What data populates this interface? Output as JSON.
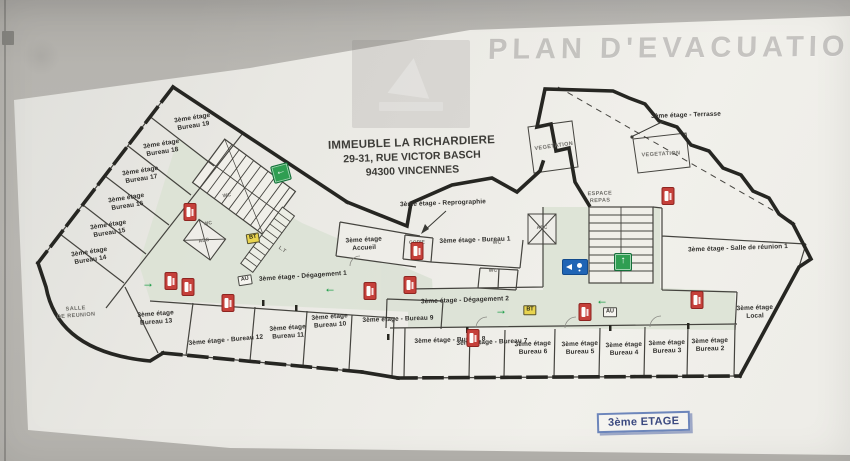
{
  "watermark": {
    "text": "PLAN D'EVACUATION"
  },
  "title": {
    "line1": "IMMEUBLE LA RICHARDIERE",
    "line2": "29-31, RUE VICTOR BASCH",
    "line3": "94300 VINCENNES"
  },
  "floor_badge": {
    "text": "3ème ETAGE"
  },
  "colors": {
    "wall_gray": "#b6b4af",
    "paper": "#efeee9",
    "corridor_green": "#dbe2d5",
    "exit_green": "#2f9e52",
    "arrow_green": "#169b42",
    "extinguisher_red": "#c5403a",
    "access_blue": "#1f64b5",
    "bt_yellow": "#e8d44f",
    "badge_border_blue": "#6d86bb",
    "badge_text_blue": "#3c4a80"
  },
  "labels": [
    {
      "name": "bureau-19",
      "lines": [
        "3ème étage",
        "Bureau 19"
      ],
      "x": 193,
      "y": 123,
      "rot": -9
    },
    {
      "name": "bureau-18",
      "lines": [
        "3ème étage",
        "Bureau 18"
      ],
      "x": 162,
      "y": 149,
      "rot": -9
    },
    {
      "name": "bureau-17",
      "lines": [
        "3ème étage",
        "Bureau 17"
      ],
      "x": 141,
      "y": 176,
      "rot": -9
    },
    {
      "name": "bureau-16",
      "lines": [
        "3ème étage",
        "Bureau 16"
      ],
      "x": 127,
      "y": 203,
      "rot": -9
    },
    {
      "name": "bureau-15",
      "lines": [
        "3ème étage",
        "Bureau 15"
      ],
      "x": 109,
      "y": 230,
      "rot": -9
    },
    {
      "name": "bureau-14",
      "lines": [
        "3ème étage",
        "Bureau 14"
      ],
      "x": 90,
      "y": 257,
      "rot": -9
    },
    {
      "name": "salle-de-reunion",
      "lines": [
        "SALLE",
        "DE REUNION"
      ],
      "x": 76,
      "y": 313,
      "rot": -4,
      "style": "area"
    },
    {
      "name": "bureau-13",
      "lines": [
        "3ème étage",
        "Bureau 13"
      ],
      "x": 156,
      "y": 319,
      "rot": -4
    },
    {
      "name": "bureau-12",
      "lines": [
        "3ème étage - Bureau 12"
      ],
      "x": 226,
      "y": 341,
      "rot": -5
    },
    {
      "name": "bureau-11",
      "lines": [
        "3ème étage",
        "Bureau 11"
      ],
      "x": 288,
      "y": 333,
      "rot": -4
    },
    {
      "name": "bureau-10",
      "lines": [
        "3ème étage",
        "Bureau 10"
      ],
      "x": 330,
      "y": 322,
      "rot": -4
    },
    {
      "name": "bureau-9",
      "lines": [
        "3ème étage - Bureau 9"
      ],
      "x": 398,
      "y": 320,
      "rot": -2
    },
    {
      "name": "bureau-8",
      "lines": [
        "3ème étage - Bureau 8"
      ],
      "x": 450,
      "y": 341,
      "rot": -2
    },
    {
      "name": "bureau-7",
      "lines": [
        "3ème étage - Bureau 7"
      ],
      "x": 492,
      "y": 343,
      "rot": -2
    },
    {
      "name": "bureau-6",
      "lines": [
        "3ème étage",
        "Bureau 6"
      ],
      "x": 533,
      "y": 349,
      "rot": -2
    },
    {
      "name": "bureau-5",
      "lines": [
        "3ème étage",
        "Bureau 5"
      ],
      "x": 580,
      "y": 349,
      "rot": -2
    },
    {
      "name": "bureau-4",
      "lines": [
        "3ème étage",
        "Bureau 4"
      ],
      "x": 624,
      "y": 350,
      "rot": -2
    },
    {
      "name": "bureau-3",
      "lines": [
        "3ème étage",
        "Bureau 3"
      ],
      "x": 667,
      "y": 348,
      "rot": -2
    },
    {
      "name": "bureau-2",
      "lines": [
        "3ème étage",
        "Bureau 2"
      ],
      "x": 710,
      "y": 346,
      "rot": -2
    },
    {
      "name": "local",
      "lines": [
        "3ème étage",
        "Local"
      ],
      "x": 755,
      "y": 313,
      "rot": -2
    },
    {
      "name": "salle-reunion-1",
      "lines": [
        "3ème étage - Salle de réunion 1"
      ],
      "x": 738,
      "y": 249,
      "rot": -2
    },
    {
      "name": "accueil",
      "lines": [
        "3ème étage",
        "Accueil"
      ],
      "x": 364,
      "y": 245,
      "rot": -3
    },
    {
      "name": "bureau-1",
      "lines": [
        "3ème étage - Bureau 1"
      ],
      "x": 475,
      "y": 241,
      "rot": -2
    },
    {
      "name": "reprographie",
      "lines": [
        "3ème étage - Reprographie"
      ],
      "x": 443,
      "y": 204,
      "rot": -2
    },
    {
      "name": "degagement-1",
      "lines": [
        "3ème étage - Dégagement 1"
      ],
      "x": 303,
      "y": 277,
      "rot": -4
    },
    {
      "name": "degagement-2",
      "lines": [
        "3ème étage - Dégagement 2"
      ],
      "x": 465,
      "y": 301,
      "rot": -2
    },
    {
      "name": "terrasse",
      "lines": [
        "3ème étage - Terrasse"
      ],
      "x": 686,
      "y": 116,
      "rot": -2
    },
    {
      "name": "vegetation-1",
      "lines": [
        "VEGETATION"
      ],
      "x": 554,
      "y": 147,
      "rot": -8,
      "style": "area"
    },
    {
      "name": "vegetation-2",
      "lines": [
        "VEGETATION"
      ],
      "x": 661,
      "y": 155,
      "rot": -3,
      "style": "area"
    },
    {
      "name": "espace-repas",
      "lines": [
        "ESPACE",
        "REPAS"
      ],
      "x": 600,
      "y": 198,
      "rot": -2,
      "style": "area"
    },
    {
      "name": "copie",
      "lines": [
        "COPIE"
      ],
      "x": 417,
      "y": 243,
      "rot": -2,
      "style": "tiny"
    },
    {
      "name": "wc-1",
      "lines": [
        "WC"
      ],
      "x": 227,
      "y": 196,
      "rot": -9,
      "style": "tiny"
    },
    {
      "name": "wc-2",
      "lines": [
        "WC"
      ],
      "x": 208,
      "y": 224,
      "rot": -9,
      "style": "tiny"
    },
    {
      "name": "asc-1",
      "lines": [
        "ASC"
      ],
      "x": 204,
      "y": 241,
      "rot": -9,
      "style": "tiny"
    },
    {
      "name": "wc-3",
      "lines": [
        "WC"
      ],
      "x": 497,
      "y": 243,
      "rot": -2,
      "style": "tiny"
    },
    {
      "name": "wc-4",
      "lines": [
        "WC"
      ],
      "x": 493,
      "y": 271,
      "rot": -2,
      "style": "tiny"
    },
    {
      "name": "asc-2",
      "lines": [
        "ASC"
      ],
      "x": 542,
      "y": 228,
      "rot": -2,
      "style": "tiny"
    },
    {
      "name": "lt",
      "lines": [
        "L.T"
      ],
      "x": 282,
      "y": 250,
      "rot": 35,
      "style": "tiny"
    }
  ],
  "icons": [
    {
      "type": "extinguisher",
      "x": 190,
      "y": 212
    },
    {
      "type": "extinguisher",
      "x": 171,
      "y": 281
    },
    {
      "type": "extinguisher",
      "x": 188,
      "y": 287
    },
    {
      "type": "extinguisher",
      "x": 228,
      "y": 303
    },
    {
      "type": "extinguisher",
      "x": 370,
      "y": 291
    },
    {
      "type": "extinguisher",
      "x": 410,
      "y": 285
    },
    {
      "type": "extinguisher",
      "x": 473,
      "y": 338
    },
    {
      "type": "extinguisher",
      "x": 417,
      "y": 251
    },
    {
      "type": "extinguisher",
      "x": 585,
      "y": 312
    },
    {
      "type": "extinguisher",
      "x": 668,
      "y": 196
    },
    {
      "type": "extinguisher",
      "x": 697,
      "y": 300
    },
    {
      "type": "exit-sign",
      "dir": "left",
      "x": 281,
      "y": 173,
      "rot": -15
    },
    {
      "type": "exit-sign",
      "dir": "up",
      "x": 623,
      "y": 262
    },
    {
      "type": "green-arrow",
      "dir": "right",
      "x": 148,
      "y": 283
    },
    {
      "type": "green-arrow",
      "dir": "left",
      "x": 330,
      "y": 288
    },
    {
      "type": "green-arrow",
      "dir": "right",
      "x": 501,
      "y": 310
    },
    {
      "type": "green-arrow",
      "dir": "left",
      "x": 602,
      "y": 300
    },
    {
      "type": "bt-badge",
      "label": "BT",
      "x": 253,
      "y": 238,
      "rot": -9
    },
    {
      "type": "bt-badge",
      "label": "BT",
      "x": 530,
      "y": 310
    },
    {
      "type": "au-badge",
      "label": "AU",
      "x": 245,
      "y": 280,
      "rot": -9
    },
    {
      "type": "au-badge",
      "label": "AU",
      "x": 610,
      "y": 312
    },
    {
      "type": "access-sign",
      "x": 575,
      "y": 267
    }
  ]
}
